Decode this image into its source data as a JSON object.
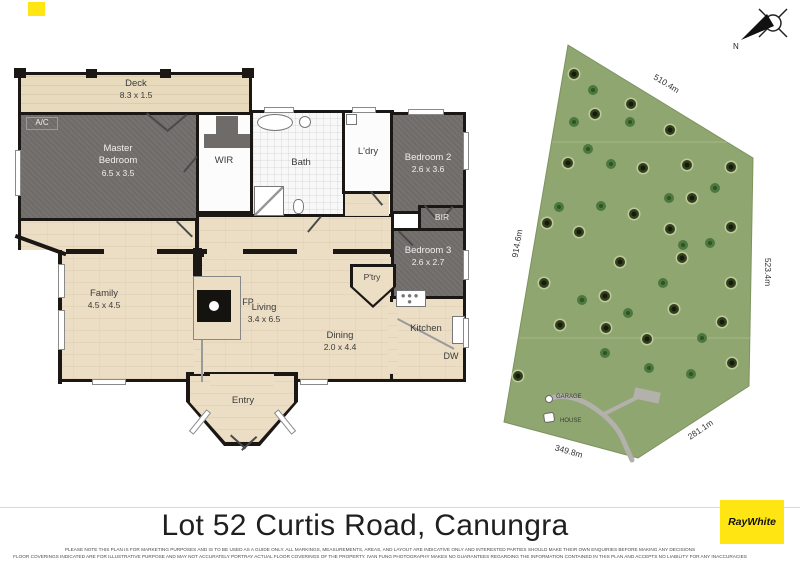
{
  "floor_plan": {
    "rooms": {
      "deck": {
        "label": "Deck",
        "dims": "8.3 x 1.5"
      },
      "master_bedroom": {
        "label": "Master Bedroom",
        "dims": "6.5 x 3.5"
      },
      "ac": {
        "label": "A/C"
      },
      "wir": {
        "label": "WIR"
      },
      "bath": {
        "label": "Bath"
      },
      "laundry": {
        "label": "L'dry"
      },
      "bedroom2": {
        "label": "Bedroom 2",
        "dims": "2.6 x 3.6"
      },
      "bir": {
        "label": "BIR"
      },
      "bedroom3": {
        "label": "Bedroom 3",
        "dims": "2.6 x 2.7"
      },
      "family": {
        "label": "Family",
        "dims": "4.5 x 4.5"
      },
      "living": {
        "label": "Living",
        "dims": "3.4 x 6.5"
      },
      "dining": {
        "label": "Dining",
        "dims": "2.0 x 4.4"
      },
      "kitchen": {
        "label": "Kitchen"
      },
      "pantry": {
        "label": "P'try"
      },
      "fireplace": {
        "label": "FP"
      },
      "dishwasher": {
        "label": "DW"
      },
      "entry": {
        "label": "Entry"
      }
    }
  },
  "site_plan": {
    "boundary_dimensions": {
      "top": "510.4m",
      "right": "523.4m",
      "bottom_right": "281.1m",
      "bottom": "349.8m",
      "left": "914.6m"
    },
    "markers": {
      "garage": "GARAGE",
      "house": "HOUSE"
    },
    "compass_label": "N",
    "colors": {
      "grass": "#90a671",
      "tree_dark": "#2c3619",
      "fern": "#457339",
      "driveway": "#b3b1ac"
    },
    "trees": {
      "dark": [
        [
          82,
          52
        ],
        [
          103,
          92
        ],
        [
          139,
          82
        ],
        [
          178,
          108
        ],
        [
          76,
          141
        ],
        [
          151,
          146
        ],
        [
          195,
          143
        ],
        [
          239,
          145
        ],
        [
          200,
          176
        ],
        [
          142,
          192
        ],
        [
          55,
          201
        ],
        [
          87,
          210
        ],
        [
          178,
          207
        ],
        [
          239,
          205
        ],
        [
          128,
          240
        ],
        [
          190,
          236
        ],
        [
          52,
          261
        ],
        [
          113,
          274
        ],
        [
          182,
          287
        ],
        [
          239,
          261
        ],
        [
          68,
          303
        ],
        [
          114,
          306
        ],
        [
          155,
          317
        ],
        [
          230,
          300
        ],
        [
          26,
          354
        ],
        [
          240,
          341
        ]
      ],
      "fern": [
        [
          101,
          68
        ],
        [
          82,
          100
        ],
        [
          138,
          100
        ],
        [
          96,
          127
        ],
        [
          119,
          142
        ],
        [
          223,
          166
        ],
        [
          177,
          176
        ],
        [
          67,
          185
        ],
        [
          109,
          184
        ],
        [
          191,
          223
        ],
        [
          218,
          221
        ],
        [
          171,
          261
        ],
        [
          90,
          278
        ],
        [
          136,
          291
        ],
        [
          210,
          316
        ],
        [
          113,
          331
        ],
        [
          157,
          346
        ],
        [
          199,
          352
        ]
      ]
    }
  },
  "footer": {
    "title": "Lot 52 Curtis Road, Canungra",
    "disclaimer_line1": "PLEASE NOTE THIS PLAN IS FOR MARKETING PURPOSES AND IS TO BE USED AS A GUIDE ONLY. ALL MARKINGS, MEASUREMENTS, AREAS, AND LAYOUT ARE INDICATIVE ONLY AND INTERESTED PARTIES SHOULD MAKE THEIR OWN ENQUIRIES BEFORE MAKING ANY DECISIONS",
    "disclaimer_line2": "FLOOR COVERINGS INDICATED ARE FOR ILLUSTRATIVE PURPOSE AND MAY NOT ACCURATELY PORTRAY ACTUAL FLOOR COVERINGS OF THE PROPERTY. IVAN FUNG PHOTOGRAPHY MAKES NO GUARANTEES REGARDING THE INFORMATION CONTAINED IN THIS PLAN AND ACCEPTS NO LIABILITY FOR ANY INACCURACIES",
    "brand": "RayWhite",
    "brand_color": "#ffe512"
  }
}
